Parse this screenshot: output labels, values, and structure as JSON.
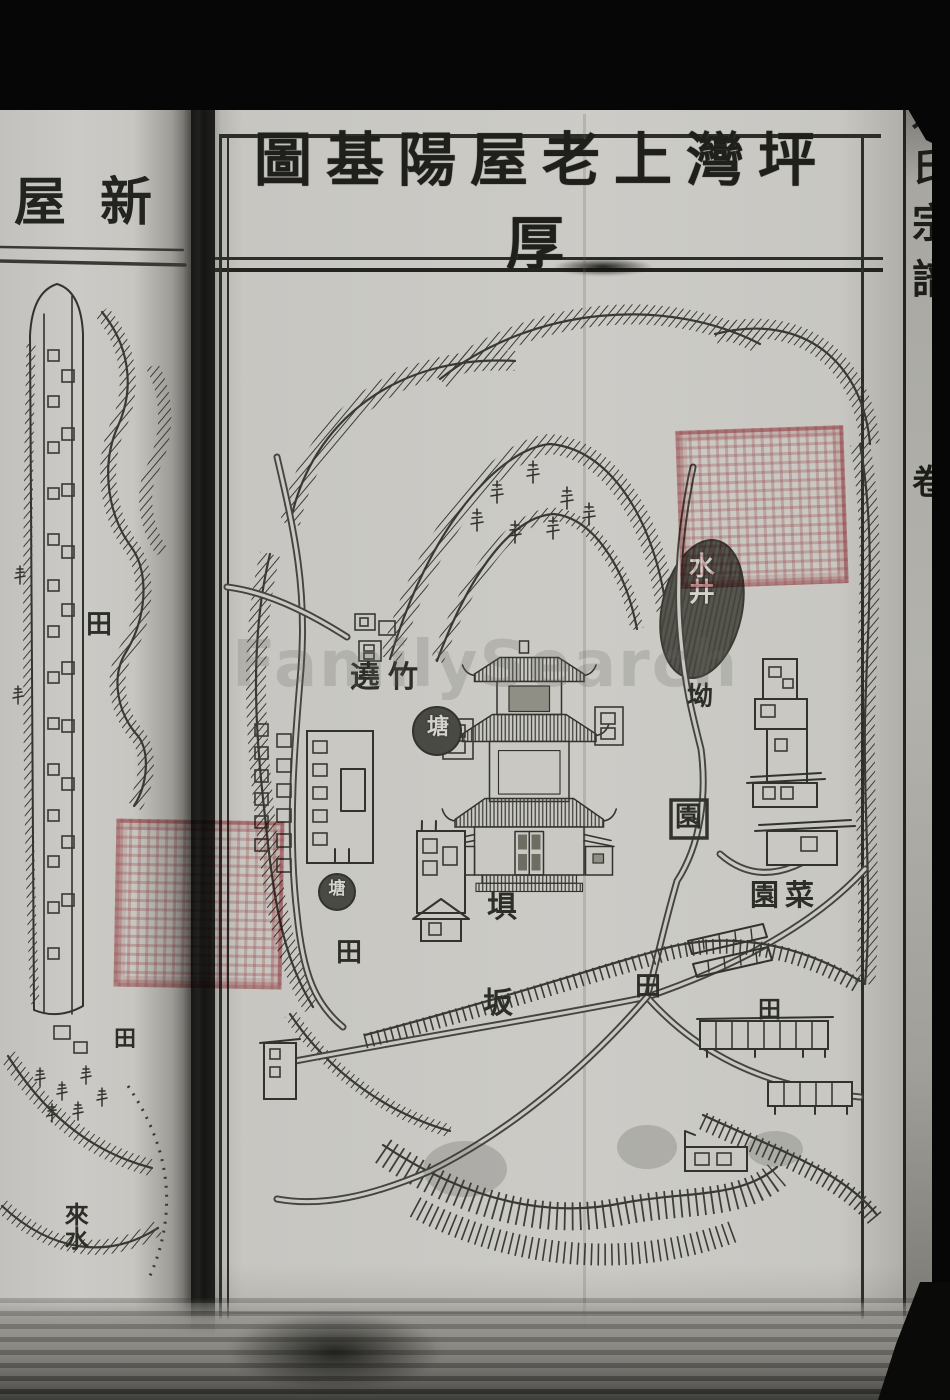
{
  "colors": {
    "paper": "#cbcac5",
    "ink": "#32322d",
    "seal_red": "#c25c64",
    "scan_background": "#0b0b0a"
  },
  "watermark": {
    "text": "FamilySearch"
  },
  "left_page": {
    "header_title": "屋新",
    "labels": {
      "field_upper": "田",
      "field_lower": "田",
      "incoming_water": "來水"
    }
  },
  "right_page": {
    "title": "圖基陽屋老上灣坪厚",
    "labels": {
      "well": "水井",
      "bamboo_ring": "遶竹",
      "pond_upper": "塘",
      "pond_lower": "塘",
      "mountain_pass": "坳",
      "garden": "園",
      "vegetable_garden": "園菜",
      "dam": "埧",
      "slope": "坂",
      "field_west": "田",
      "field_middle": "田",
      "field_east": "田"
    }
  },
  "spine": {
    "book_title": "姚氏宗譜",
    "volume_label": "卷"
  }
}
